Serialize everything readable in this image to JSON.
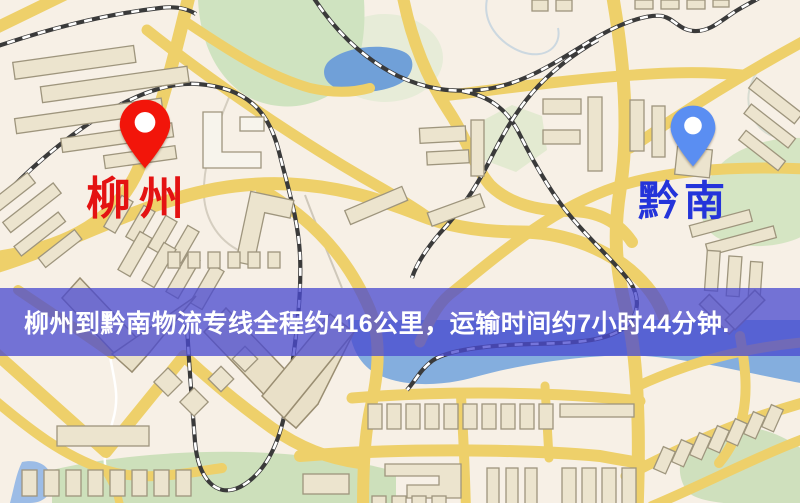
{
  "markers": {
    "origin": {
      "label": "柳州",
      "label_color": "#e41212",
      "pin_color": "#f2150a",
      "pin_style": "map-pin-with-hole"
    },
    "destination": {
      "label": "黔南",
      "label_color": "#2434da",
      "pin_color": "#5a8ef2",
      "pin_style": "map-pin-with-hole"
    }
  },
  "banner": {
    "text": "柳州到黔南物流专线全程约416公里，运输时间约7小时44分钟.",
    "distance_text": "416公里",
    "duration_text": "7小时44分钟",
    "background_color": "#4a4ad0",
    "background_opacity": 0.76,
    "text_color": "#ffffff"
  },
  "map_palette": {
    "background": "#f7f0e6",
    "road_yellow": "#eed06a",
    "building_fill": "#ece4ce",
    "building_outline": "#9e957d",
    "park_green": "#d3e3c2",
    "water_blue": "#84aede",
    "railway_dark": "#3a3a3a",
    "railway_dash": "#ffffff"
  }
}
